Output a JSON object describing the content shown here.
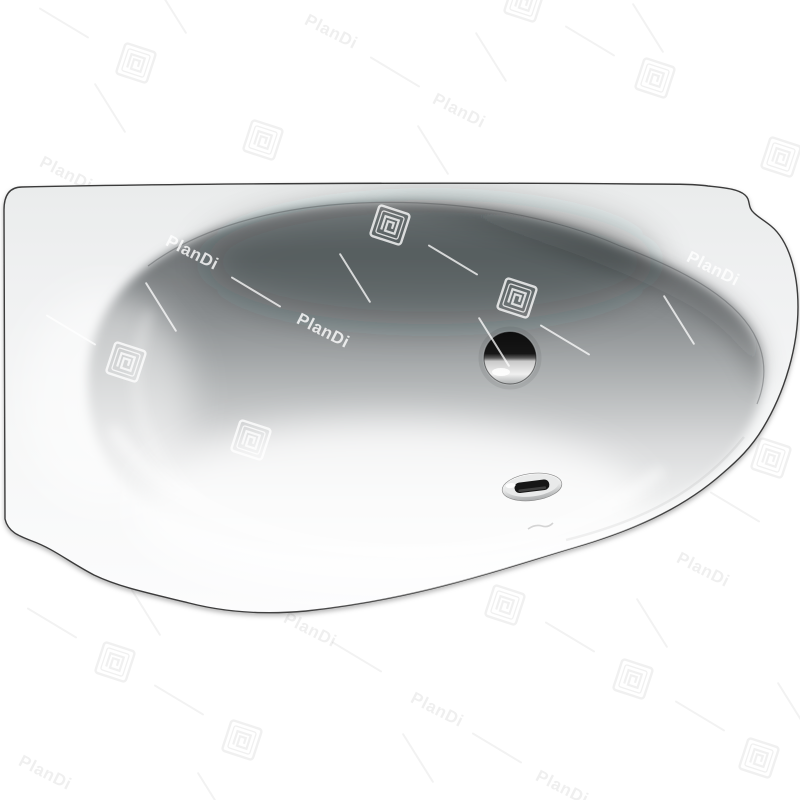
{
  "image": {
    "kind": "product-photo",
    "subject": "asymmetric-bathtub-top-view",
    "background_color": "#ffffff"
  },
  "watermark": {
    "text": "PlanDi",
    "logo_icon": "plandi-square-spiral-logo",
    "gray_color": "rgba(40,40,40,0.07)",
    "white_color": "rgba(255,255,255,0.78)",
    "items": [
      {
        "t": "text",
        "x": 66,
        "y": 174,
        "tone": "gray"
      },
      {
        "t": "text",
        "x": 331,
        "y": 32,
        "tone": "gray"
      },
      {
        "t": "text",
        "x": 459,
        "y": 111,
        "tone": "gray"
      },
      {
        "t": "text",
        "x": 310,
        "y": 630,
        "tone": "gray"
      },
      {
        "t": "text",
        "x": 45,
        "y": 773,
        "tone": "gray"
      },
      {
        "t": "text",
        "x": 703,
        "y": 570,
        "tone": "gray"
      },
      {
        "t": "text",
        "x": 437,
        "y": 710,
        "tone": "gray"
      },
      {
        "t": "text",
        "x": 562,
        "y": 788,
        "tone": "gray"
      },
      {
        "t": "text",
        "x": 192,
        "y": 253,
        "tone": "white"
      },
      {
        "t": "text",
        "x": 323,
        "y": 331,
        "tone": "white"
      },
      {
        "t": "text",
        "x": 713,
        "y": 269,
        "tone": "white"
      },
      {
        "t": "logo",
        "x": 136,
        "y": 63,
        "tone": "gray"
      },
      {
        "t": "logo",
        "x": 263,
        "y": 140,
        "tone": "gray"
      },
      {
        "t": "logo",
        "x": 655,
        "y": 78,
        "tone": "gray"
      },
      {
        "t": "logo",
        "x": 781,
        "y": 157,
        "tone": "gray"
      },
      {
        "t": "logo",
        "x": 771,
        "y": 458,
        "tone": "gray"
      },
      {
        "t": "logo",
        "x": 115,
        "y": 662,
        "tone": "gray"
      },
      {
        "t": "logo",
        "x": 242,
        "y": 740,
        "tone": "gray"
      },
      {
        "t": "logo",
        "x": 633,
        "y": 679,
        "tone": "gray"
      },
      {
        "t": "logo",
        "x": 759,
        "y": 758,
        "tone": "gray"
      },
      {
        "t": "logo",
        "x": 505,
        "y": 605,
        "tone": "gray"
      },
      {
        "t": "logo",
        "x": 524,
        "y": 2,
        "tone": "gray"
      },
      {
        "t": "logo",
        "x": 390,
        "y": 225,
        "tone": "white"
      },
      {
        "t": "logo",
        "x": 517,
        "y": 298,
        "tone": "white"
      },
      {
        "t": "logo",
        "x": 126,
        "y": 362,
        "tone": "white"
      },
      {
        "t": "logo",
        "x": 251,
        "y": 440,
        "tone": "white"
      },
      {
        "t": "line-dr",
        "x": 64,
        "y": 23,
        "tone": "gray"
      },
      {
        "t": "line-dr",
        "x": 395,
        "y": 72,
        "tone": "gray"
      },
      {
        "t": "line-dr",
        "x": 590,
        "y": 41,
        "tone": "gray"
      },
      {
        "t": "line-dr",
        "x": 357,
        "y": 657,
        "tone": "gray"
      },
      {
        "t": "line-dr",
        "x": 570,
        "y": 637,
        "tone": "gray"
      },
      {
        "t": "line-dr",
        "x": 497,
        "y": 748,
        "tone": "gray"
      },
      {
        "t": "line-dr",
        "x": 700,
        "y": 716,
        "tone": "gray"
      },
      {
        "t": "line-dr",
        "x": 52,
        "y": 623,
        "tone": "gray"
      },
      {
        "t": "line-dr",
        "x": 179,
        "y": 700,
        "tone": "gray"
      },
      {
        "t": "line-dr",
        "x": 735,
        "y": 507,
        "tone": "gray"
      },
      {
        "t": "line-dr",
        "x": 256,
        "y": 292,
        "tone": "white"
      },
      {
        "t": "line-dr",
        "x": 453,
        "y": 260,
        "tone": "white"
      },
      {
        "t": "line-dr",
        "x": 71,
        "y": 330,
        "tone": "white"
      },
      {
        "t": "line-dr",
        "x": 565,
        "y": 340,
        "tone": "white"
      },
      {
        "t": "line-steep",
        "x": 491,
        "y": 57,
        "tone": "gray"
      },
      {
        "t": "line-steep",
        "x": 418,
        "y": 758,
        "tone": "gray"
      },
      {
        "t": "line-steep",
        "x": 652,
        "y": 623,
        "tone": "gray"
      },
      {
        "t": "line-steep",
        "x": 793,
        "y": 707,
        "tone": "gray"
      },
      {
        "t": "line-steep",
        "x": 145,
        "y": 611,
        "tone": "gray"
      },
      {
        "t": "line-steep",
        "x": 213,
        "y": 797,
        "tone": "gray"
      },
      {
        "t": "line-steep",
        "x": 171,
        "y": 9,
        "tone": "gray"
      },
      {
        "t": "line-steep",
        "x": 648,
        "y": 28,
        "tone": "gray"
      },
      {
        "t": "line-steep",
        "x": 433,
        "y": 150,
        "tone": "gray"
      },
      {
        "t": "line-steep",
        "x": 110,
        "y": 108,
        "tone": "gray"
      },
      {
        "t": "line-steep",
        "x": 161,
        "y": 307,
        "tone": "white"
      },
      {
        "t": "line-steep",
        "x": 355,
        "y": 278,
        "tone": "white"
      },
      {
        "t": "line-steep",
        "x": 679,
        "y": 320,
        "tone": "white"
      },
      {
        "t": "line-steep",
        "x": 494,
        "y": 342,
        "tone": "white"
      }
    ]
  },
  "tub": {
    "shell_color_top": "#eaecec",
    "shell_color_bottom": "#fcfcfd",
    "basin_dark": "#717577",
    "basin_light": "#f7f7f7",
    "outline_color": "#3a3a3a",
    "drain": {
      "x": 510,
      "y": 358,
      "radius": 26
    },
    "overflow": {
      "x": 532,
      "y": 487,
      "slot_color": "#161616"
    },
    "brand_mark": {
      "x": 543,
      "y": 527,
      "legible": false
    }
  }
}
